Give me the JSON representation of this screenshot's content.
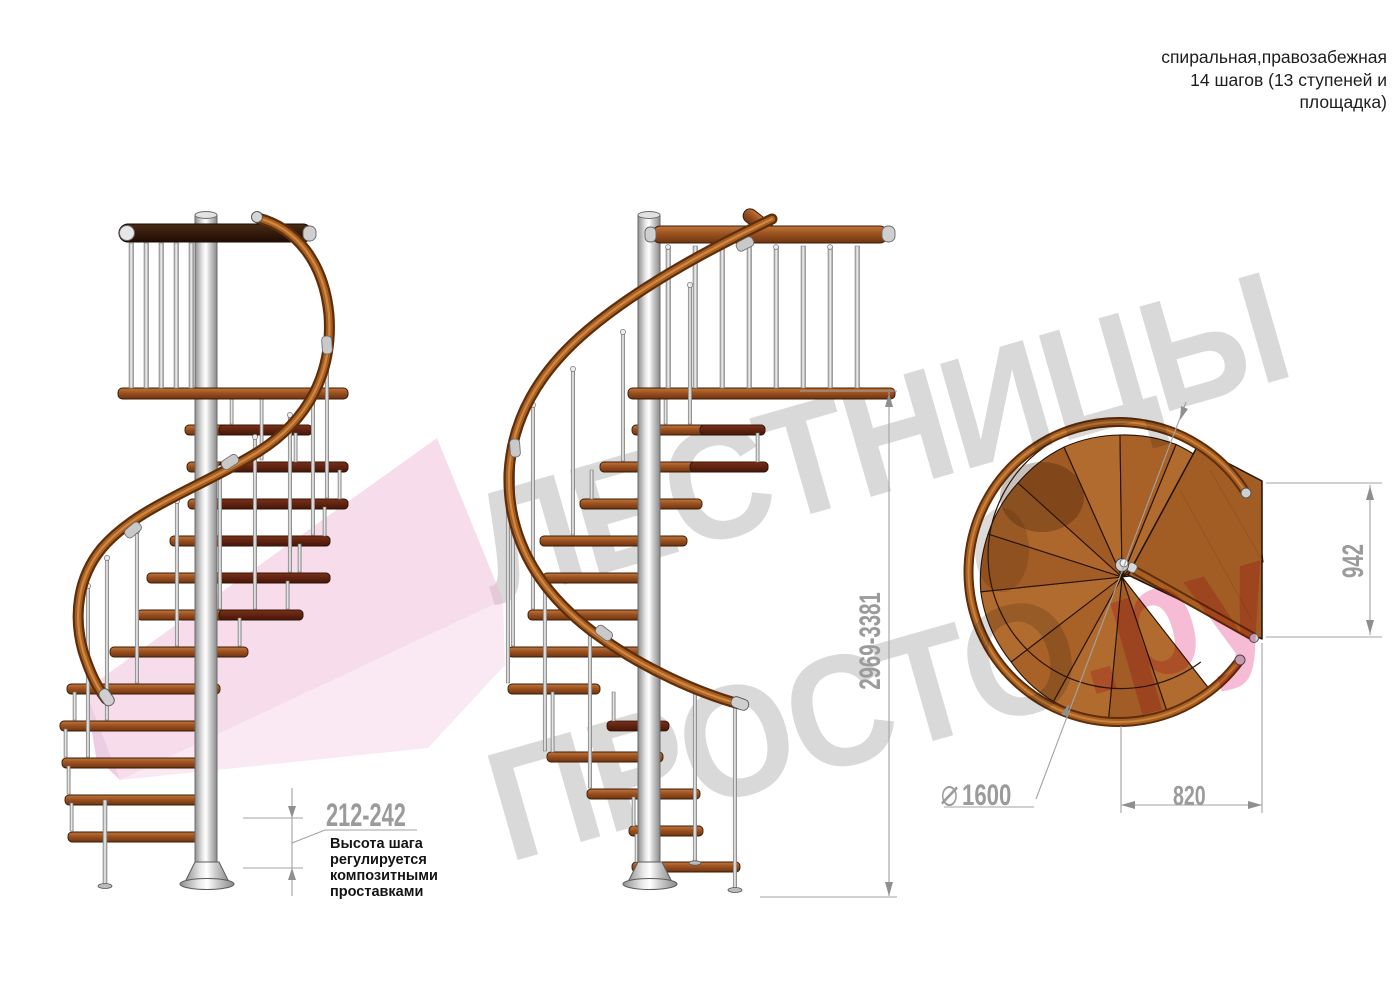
{
  "header": {
    "title_lines": [
      "спиральная,правозабежная",
      "14 шагов (13 ступеней и",
      "площадка)"
    ]
  },
  "watermark": {
    "line1": "ЛЕСТНИЦЫ",
    "line2_gray": "ПРОСТО",
    "line2_pink": ".ру",
    "gray_color": "#d9d9d9",
    "pink_color": "#f6bcd6"
  },
  "annotations": {
    "step_height": {
      "value": "212-242",
      "note_lines": [
        "Высота шага",
        "регулируется",
        "композитными",
        "проставками"
      ]
    },
    "total_height": {
      "value": "2969-3381"
    },
    "platform_side": {
      "value": "942"
    },
    "diameter": {
      "symbol": "⌀",
      "value": "1600",
      "label": "⌀ 1600"
    },
    "platform_width": {
      "value": "820"
    }
  },
  "palette": {
    "dimension_gray": "#9b9b9b",
    "note_black": "#141414",
    "wood_step": "#9c5220",
    "wood_top_view": "#a96428",
    "handrail_brown": "#8a4a1c",
    "metal_gray": "#d9d9d9",
    "ribbon_pink": "#f0b9da",
    "background": "#ffffff"
  }
}
